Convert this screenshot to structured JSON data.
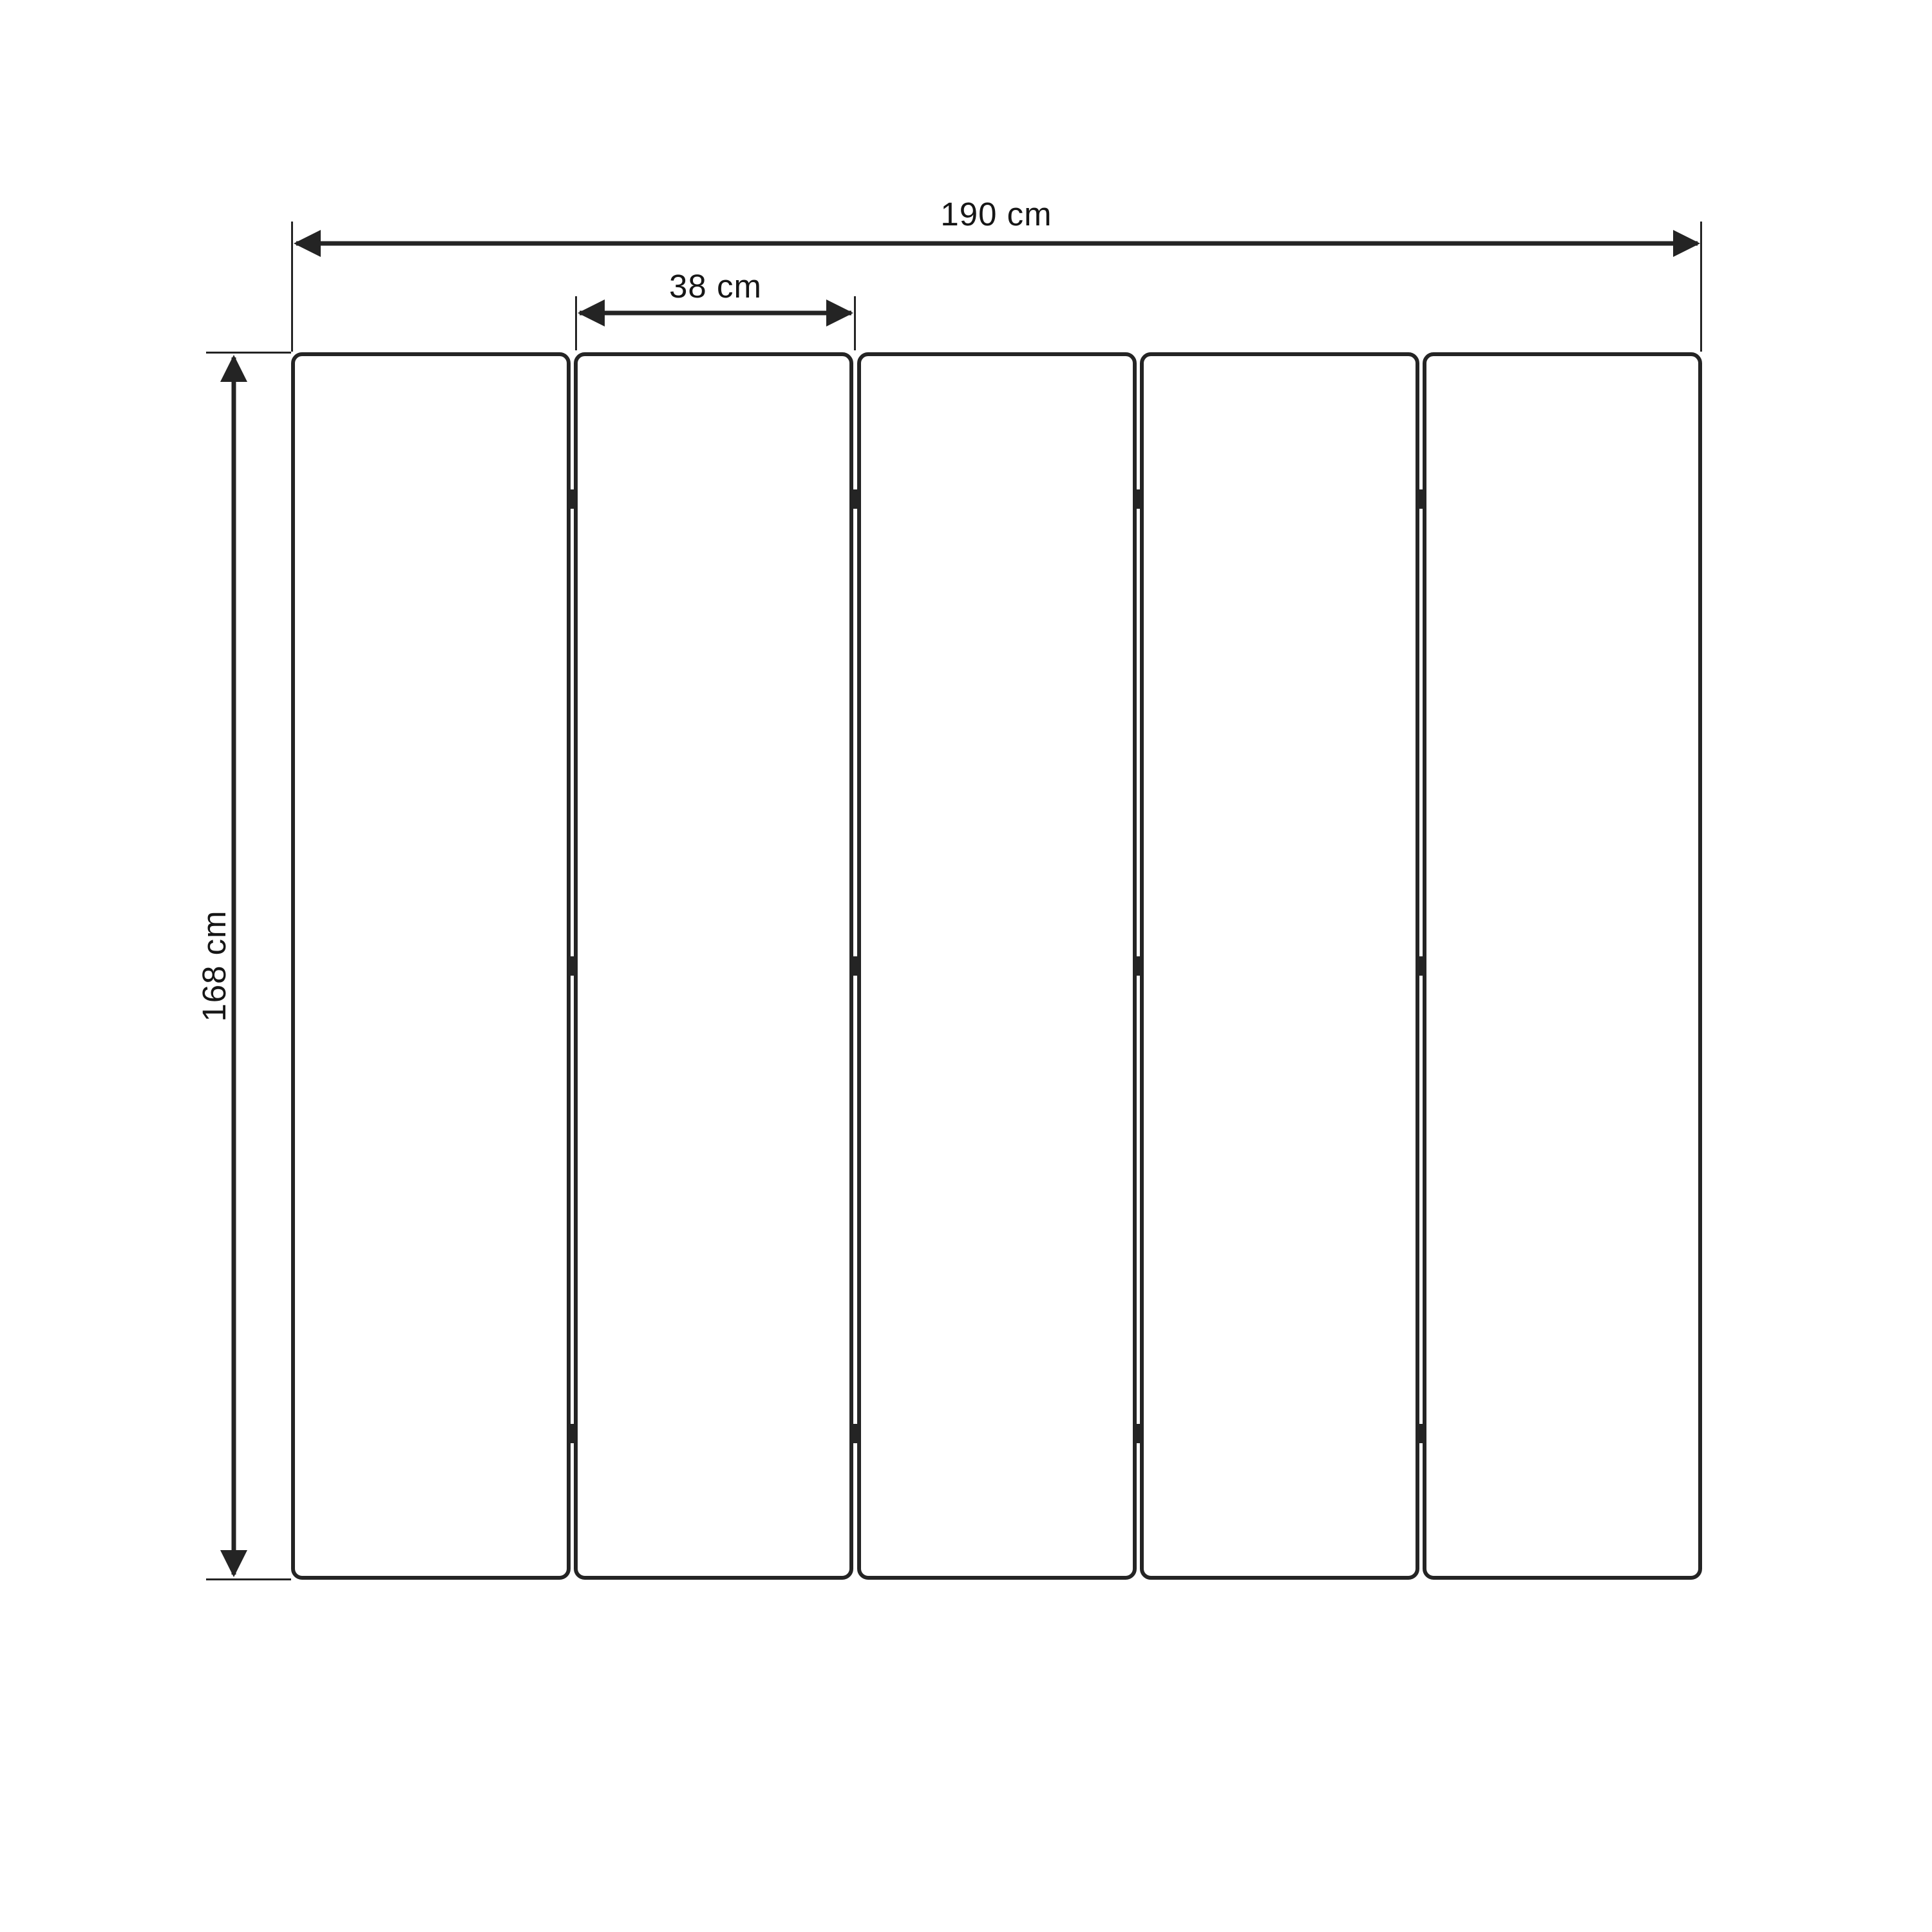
{
  "diagram": {
    "type": "panel-screen-dimension-drawing",
    "panel_count": 5,
    "hinge_rows": 3,
    "hinge_columns": 4,
    "unit": "cm",
    "dimensions": {
      "total_width": {
        "value": 190,
        "label": "190 cm"
      },
      "panel_width": {
        "value": 38,
        "label": "38 cm"
      },
      "height": {
        "value": 168,
        "label": "168 cm"
      }
    },
    "colors": {
      "background": "#ffffff",
      "line": "#242424",
      "text": "#161616"
    }
  }
}
